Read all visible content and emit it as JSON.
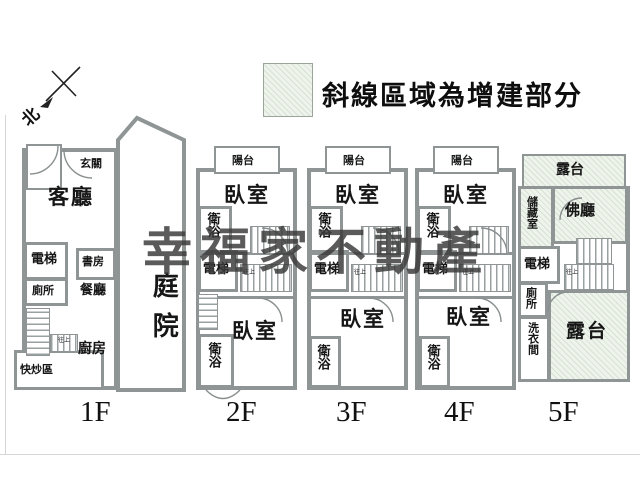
{
  "legend": {
    "text": "斜線區域為增建部分",
    "hatch_fill": "#eef4ec"
  },
  "north": {
    "label": "北"
  },
  "watermark": {
    "text": "幸福家不動產",
    "color": "#3b3b3b"
  },
  "stair_note": "往上",
  "colors": {
    "wall": "#8f9494",
    "hatch_fill": "#eef4ec"
  },
  "floors": [
    {
      "label": "1F",
      "rooms": {
        "entry": "玄關",
        "living": "客廳",
        "elevator": "電梯",
        "study": "書房",
        "toilet": "廁所",
        "dining": "餐廳",
        "kitchen": "廚房",
        "stir_fry": "快炒區",
        "courtyard": "庭院"
      }
    },
    {
      "label": "2F",
      "rooms": {
        "balcony": "陽台",
        "bedroom_top": "臥室",
        "bath_top": "衛浴",
        "elevator": "電梯",
        "bedroom_bottom": "臥室",
        "bath_bottom": "衛浴"
      }
    },
    {
      "label": "3F",
      "rooms": {
        "balcony": "陽台",
        "bedroom_top": "臥室",
        "bath_top": "衛浴",
        "elevator": "電梯",
        "bedroom_bottom": "臥室",
        "bath_bottom": "衛浴"
      }
    },
    {
      "label": "4F",
      "rooms": {
        "balcony": "陽台",
        "bedroom_top": "臥室",
        "bath_top": "衛浴",
        "elevator": "電梯",
        "bedroom_bottom": "臥室",
        "bath_bottom": "衛浴"
      }
    },
    {
      "label": "5F",
      "rooms": {
        "terrace_top": "露台",
        "storage": "儲藏室",
        "buddha_hall": "佛廳",
        "elevator": "電梯",
        "toilet": "廁所",
        "laundry": "洗衣間",
        "terrace_bottom": "露台"
      }
    }
  ]
}
